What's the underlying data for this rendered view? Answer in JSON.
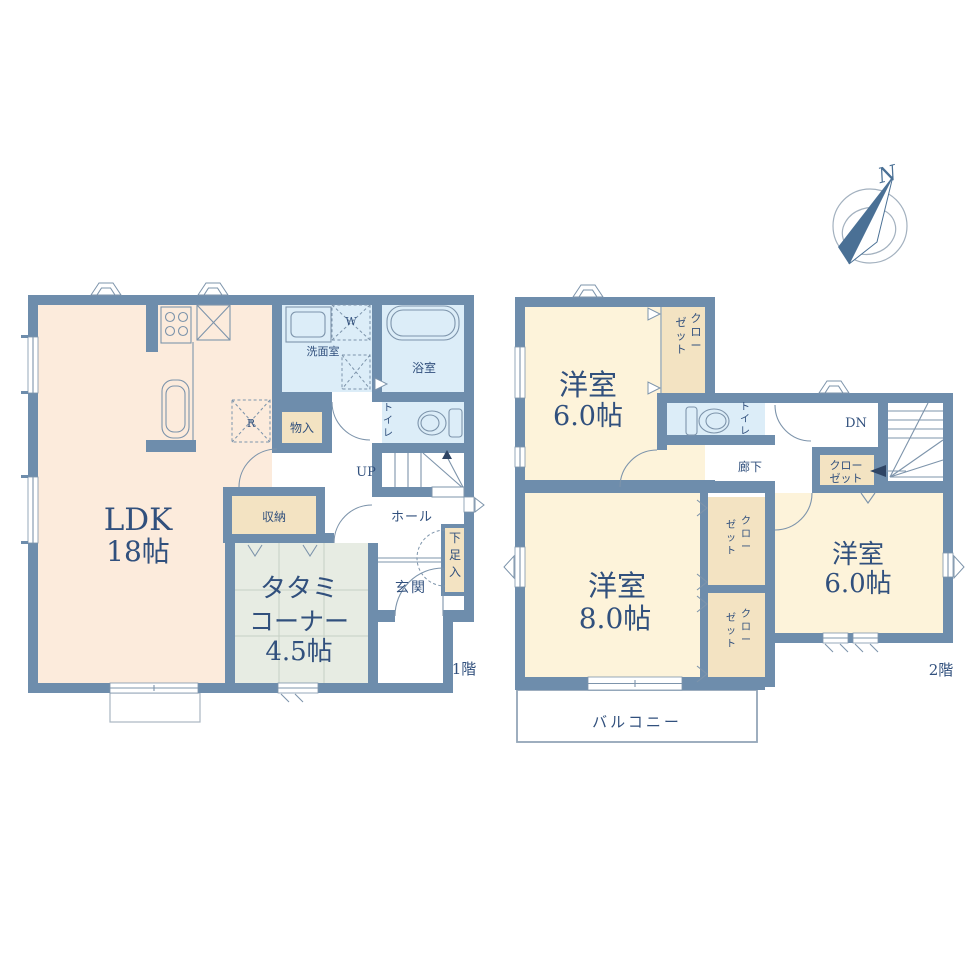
{
  "palette": {
    "wall": "#6e8dac",
    "room-peach": "#fcebdc",
    "room-cream": "#fdf3da",
    "room-blue": "#dcedf8",
    "room-tatami": "#e7ece3",
    "room-beige": "#f3e3c2",
    "ink": "#31507d",
    "line": "#7d94ab",
    "compass": "#4a7095"
  },
  "compass": {
    "label": "N"
  },
  "floor1": {
    "label": "1階",
    "ldk": {
      "name": "LDK",
      "size": "18帖"
    },
    "tatami": {
      "line1": "タタミ",
      "line2": "コーナー",
      "line3": "4.5帖"
    },
    "washroom": "洗面室",
    "bath": "浴室",
    "toilet": "トイレ",
    "mono_ire": "物入",
    "shuno": "収納",
    "hall": "ホール",
    "genkan": "玄関",
    "shoe_box": "下足入",
    "stairs": "UP",
    "washer": "W",
    "fridge": "R"
  },
  "floor2": {
    "label": "2階",
    "room_nw": {
      "name": "洋室",
      "size": "6.0帖"
    },
    "room_sw": {
      "name": "洋室",
      "size": "8.0帖"
    },
    "room_e": {
      "name": "洋室",
      "size": "6.0帖"
    },
    "closet_nw": {
      "line1": "クロー",
      "line2": "ゼット"
    },
    "closet_mid": {
      "line1": "クロー",
      "line2": "ゼット"
    },
    "closet_sw_upper": {
      "line1": "クロー",
      "line2": "ゼット"
    },
    "closet_sw_lower": {
      "line1": "クロー",
      "line2": "ゼット"
    },
    "toilet": "トイレ",
    "corridor": "廊下",
    "stairs": "DN",
    "balcony": "バルコニー"
  }
}
